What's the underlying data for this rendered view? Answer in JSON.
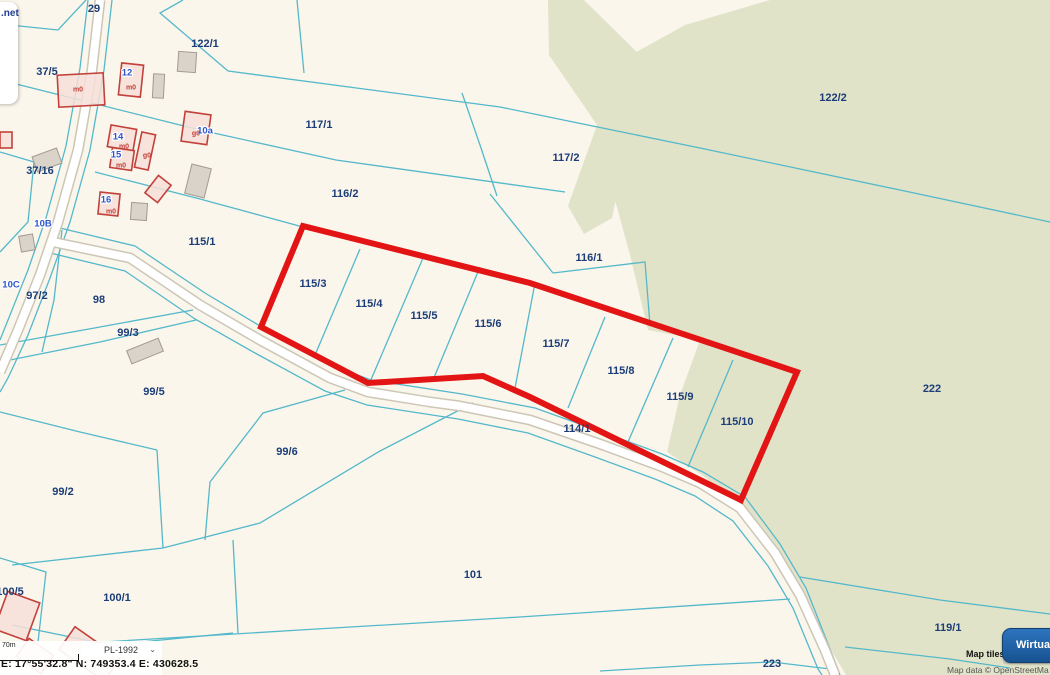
{
  "overlays": {
    "watermark": {
      "net_label": ".net",
      "logo_letter": "M",
      "badge_label": "tr"
    },
    "statusbar": {
      "scale_label": "70m",
      "crs_value": "PL-1992",
      "chevron": "⌄",
      "coords_text": "E: 17°55'32.8\"  N: 749353.4  E: 430628.5"
    },
    "attribution": {
      "line1": "Map tiles",
      "line2": "Map data © OpenStreetMa"
    },
    "button": {
      "label": "Wirtualn"
    }
  },
  "map": {
    "colors": {
      "background": "#faf6ec",
      "forest": "#e1e3c9",
      "parcel_line": "#54b8ca",
      "road_fill": "#ffffff",
      "road_casing": "#cdc6b6",
      "highlight": "#e21414",
      "parcel_label": "#1c3d78",
      "address_label": "#2f55cd",
      "building_red_stroke": "#c2413a",
      "building_red_fill": "#f6dfd8",
      "building_gray_fill": "#d9d3ca",
      "building_gray_stroke": "#a09a90"
    },
    "forest_polys": [
      [
        [
          770,
          0
        ],
        [
          1050,
          0
        ],
        [
          1050,
          675
        ],
        [
          846,
          675
        ],
        [
          800,
          598
        ],
        [
          752,
          518
        ],
        [
          705,
          477
        ],
        [
          667,
          452
        ],
        [
          680,
          395
        ],
        [
          700,
          340
        ],
        [
          648,
          330
        ],
        [
          630,
          255
        ],
        [
          615,
          200
        ],
        [
          603,
          128
        ],
        [
          622,
          60
        ],
        [
          685,
          25
        ]
      ],
      [
        [
          548,
          0
        ],
        [
          584,
          0
        ],
        [
          645,
          60
        ],
        [
          612,
          218
        ],
        [
          584,
          234
        ],
        [
          568,
          206
        ],
        [
          597,
          125
        ],
        [
          549,
          55
        ]
      ]
    ],
    "roads": [
      {
        "pts": [
          [
            100,
            0
          ],
          [
            92,
            70
          ],
          [
            78,
            150
          ],
          [
            58,
            222
          ],
          [
            40,
            275
          ],
          [
            18,
            330
          ],
          [
            0,
            372
          ]
        ]
      },
      {
        "pts": [
          [
            53,
            242
          ],
          [
            130,
            258
          ],
          [
            200,
            305
          ],
          [
            260,
            340
          ],
          [
            330,
            378
          ],
          [
            368,
            392
          ],
          [
            430,
            402
          ],
          [
            460,
            406
          ],
          [
            530,
            420
          ],
          [
            600,
            444
          ],
          [
            660,
            466
          ],
          [
            700,
            483
          ],
          [
            740,
            508
          ],
          [
            775,
            553
          ],
          [
            800,
            595
          ],
          [
            825,
            650
          ],
          [
            835,
            675
          ]
        ]
      }
    ],
    "parcel_lines": [
      [
        [
          0,
          24
        ],
        [
          58,
          30
        ],
        [
          86,
          0
        ]
      ],
      [
        [
          183,
          0
        ],
        [
          160,
          13
        ],
        [
          228,
          71
        ]
      ],
      [
        [
          297,
          0
        ],
        [
          304,
          73
        ]
      ],
      [
        [
          228,
          71
        ],
        [
          500,
          107
        ],
        [
          700,
          148
        ],
        [
          900,
          190
        ],
        [
          1050,
          222
        ]
      ],
      [
        [
          0,
          80
        ],
        [
          60,
          95
        ],
        [
          200,
          130
        ],
        [
          336,
          160
        ],
        [
          565,
          192
        ]
      ],
      [
        [
          95,
          172
        ],
        [
          200,
          199
        ],
        [
          303,
          227
        ]
      ],
      [
        [
          462,
          93
        ],
        [
          480,
          145
        ],
        [
          497,
          196
        ]
      ],
      [
        [
          490,
          194
        ],
        [
          553,
          273
        ]
      ],
      [
        [
          553,
          273
        ],
        [
          645,
          262
        ],
        [
          650,
          325
        ]
      ],
      [
        [
          0,
          152
        ],
        [
          34,
          162
        ],
        [
          28,
          222
        ],
        [
          0,
          252
        ]
      ],
      [
        [
          62,
          230
        ],
        [
          54,
          300
        ],
        [
          42,
          352
        ]
      ],
      [
        [
          0,
          345
        ],
        [
          100,
          327
        ],
        [
          193,
          310
        ]
      ],
      [
        [
          0,
          362
        ],
        [
          100,
          342
        ],
        [
          196,
          320
        ]
      ],
      [
        [
          0,
          412
        ],
        [
          80,
          432
        ],
        [
          157,
          450
        ]
      ],
      [
        [
          157,
          450
        ],
        [
          163,
          548
        ]
      ],
      [
        [
          345,
          390
        ],
        [
          263,
          413
        ],
        [
          210,
          482
        ],
        [
          205,
          540
        ]
      ],
      [
        [
          473,
          403
        ],
        [
          380,
          451
        ],
        [
          260,
          523
        ],
        [
          163,
          548
        ],
        [
          12,
          565
        ]
      ],
      [
        [
          12,
          625
        ],
        [
          110,
          645
        ],
        [
          233,
          633
        ]
      ],
      [
        [
          233,
          540
        ],
        [
          238,
          633
        ]
      ],
      [
        [
          0,
          558
        ],
        [
          46,
          572
        ],
        [
          38,
          642
        ]
      ],
      [
        [
          600,
          671
        ],
        [
          700,
          665
        ],
        [
          772,
          662
        ],
        [
          830,
          669
        ]
      ],
      [
        [
          800,
          577
        ],
        [
          940,
          600
        ],
        [
          1050,
          614
        ]
      ],
      [
        [
          845,
          647
        ],
        [
          950,
          659
        ],
        [
          1010,
          668
        ]
      ],
      [
        [
          70,
          644
        ],
        [
          300,
          630
        ],
        [
          520,
          617
        ],
        [
          790,
          599
        ]
      ],
      [
        [
          60,
          228
        ],
        [
          135,
          246
        ],
        [
          205,
          293
        ],
        [
          265,
          329
        ],
        [
          336,
          367
        ],
        [
          371,
          380
        ],
        [
          462,
          394
        ],
        [
          535,
          408
        ],
        [
          602,
          432
        ],
        [
          662,
          454
        ],
        [
          703,
          472
        ],
        [
          745,
          497
        ],
        [
          780,
          544
        ],
        [
          806,
          588
        ],
        [
          830,
          649
        ],
        [
          840,
          675
        ]
      ],
      [
        [
          46,
          252
        ],
        [
          125,
          271
        ],
        [
          195,
          319
        ],
        [
          255,
          353
        ],
        [
          325,
          391
        ],
        [
          367,
          405
        ],
        [
          458,
          419
        ],
        [
          528,
          433
        ],
        [
          595,
          457
        ],
        [
          655,
          479
        ],
        [
          695,
          496
        ],
        [
          733,
          521
        ],
        [
          768,
          566
        ],
        [
          793,
          608
        ],
        [
          818,
          669
        ],
        [
          822,
          675
        ]
      ],
      [
        [
          112,
          0
        ],
        [
          104,
          70
        ],
        [
          90,
          150
        ],
        [
          70,
          222
        ],
        [
          50,
          278
        ],
        [
          28,
          335
        ],
        [
          8,
          378
        ],
        [
          0,
          392
        ]
      ],
      [
        [
          88,
          0
        ],
        [
          80,
          68
        ],
        [
          66,
          146
        ],
        [
          46,
          218
        ],
        [
          28,
          270
        ],
        [
          6,
          325
        ],
        [
          0,
          340
        ]
      ],
      [
        [
          360,
          249
        ],
        [
          315,
          355
        ]
      ],
      [
        [
          423,
          258
        ],
        [
          370,
          382
        ]
      ],
      [
        [
          480,
          267
        ],
        [
          433,
          380
        ]
      ],
      [
        [
          535,
          283
        ],
        [
          515,
          388
        ]
      ],
      [
        [
          605,
          317
        ],
        [
          568,
          408
        ]
      ],
      [
        [
          673,
          338
        ],
        [
          628,
          442
        ]
      ],
      [
        [
          733,
          360
        ],
        [
          688,
          467
        ]
      ]
    ],
    "highlight_polygon": [
      [
        303,
        226
      ],
      [
        530,
        283
      ],
      [
        797,
        372
      ],
      [
        741,
        500
      ],
      [
        530,
        397
      ],
      [
        483,
        376
      ],
      [
        368,
        383
      ],
      [
        261,
        327
      ]
    ],
    "buildings_red": [
      {
        "x": 58,
        "y": 74,
        "w": 46,
        "h": 32,
        "r": -3
      },
      {
        "x": 120,
        "y": 64,
        "w": 22,
        "h": 32,
        "r": 6
      },
      {
        "x": 109,
        "y": 127,
        "w": 26,
        "h": 22,
        "r": 10
      },
      {
        "x": 111,
        "y": 149,
        "w": 22,
        "h": 20,
        "r": 8
      },
      {
        "x": 138,
        "y": 133,
        "w": 14,
        "h": 36,
        "r": 12
      },
      {
        "x": 183,
        "y": 113,
        "w": 26,
        "h": 30,
        "r": 8
      },
      {
        "x": 99,
        "y": 193,
        "w": 20,
        "h": 22,
        "r": 6
      },
      {
        "x": 150,
        "y": 178,
        "w": 16,
        "h": 22,
        "r": 38
      },
      {
        "x": 0,
        "y": 132,
        "w": 12,
        "h": 16,
        "r": 0
      },
      {
        "x": 62,
        "y": 640,
        "w": 55,
        "h": 28,
        "r": 35
      },
      {
        "x": 20,
        "y": 645,
        "w": 30,
        "h": 22,
        "r": 35
      },
      {
        "x": 0,
        "y": 596,
        "w": 34,
        "h": 40,
        "r": 20
      }
    ],
    "buildings_gray": [
      {
        "x": 178,
        "y": 52,
        "w": 18,
        "h": 20,
        "r": 4
      },
      {
        "x": 153,
        "y": 74,
        "w": 11,
        "h": 24,
        "r": 3
      },
      {
        "x": 188,
        "y": 166,
        "w": 20,
        "h": 30,
        "r": 14
      },
      {
        "x": 131,
        "y": 203,
        "w": 16,
        "h": 17,
        "r": 4
      },
      {
        "x": 34,
        "y": 152,
        "w": 26,
        "h": 16,
        "r": -20
      },
      {
        "x": 128,
        "y": 344,
        "w": 34,
        "h": 14,
        "r": -22
      },
      {
        "x": 20,
        "y": 235,
        "w": 14,
        "h": 16,
        "r": -10
      }
    ],
    "parcel_labels": [
      {
        "t": "29",
        "x": 94,
        "y": 8
      },
      {
        "t": "122/1",
        "x": 205,
        "y": 43
      },
      {
        "t": "122/2",
        "x": 833,
        "y": 97
      },
      {
        "t": "37/5",
        "x": 47,
        "y": 71
      },
      {
        "t": "117/1",
        "x": 319,
        "y": 124
      },
      {
        "t": "117/2",
        "x": 566,
        "y": 157
      },
      {
        "t": "116/2",
        "x": 345,
        "y": 193
      },
      {
        "t": "116/1",
        "x": 589,
        "y": 257
      },
      {
        "t": "115/1",
        "x": 202,
        "y": 241
      },
      {
        "t": "37/16",
        "x": 40,
        "y": 170
      },
      {
        "t": "97/2",
        "x": 37,
        "y": 295
      },
      {
        "t": "98",
        "x": 99,
        "y": 299
      },
      {
        "t": "99/3",
        "x": 128,
        "y": 332
      },
      {
        "t": "99/5",
        "x": 154,
        "y": 391
      },
      {
        "t": "99/6",
        "x": 287,
        "y": 451
      },
      {
        "t": "99/2",
        "x": 63,
        "y": 491
      },
      {
        "t": "100/5",
        "x": 10,
        "y": 591
      },
      {
        "t": "100/1",
        "x": 117,
        "y": 597
      },
      {
        "t": "101",
        "x": 473,
        "y": 574
      },
      {
        "t": "114/1",
        "x": 577,
        "y": 428
      },
      {
        "t": "115/3",
        "x": 313,
        "y": 283
      },
      {
        "t": "115/4",
        "x": 369,
        "y": 303
      },
      {
        "t": "115/5",
        "x": 424,
        "y": 315
      },
      {
        "t": "115/6",
        "x": 488,
        "y": 323
      },
      {
        "t": "115/7",
        "x": 556,
        "y": 343
      },
      {
        "t": "115/8",
        "x": 621,
        "y": 370
      },
      {
        "t": "115/9",
        "x": 680,
        "y": 396
      },
      {
        "t": "115/10",
        "x": 737,
        "y": 421
      },
      {
        "t": "222",
        "x": 932,
        "y": 388
      },
      {
        "t": "223",
        "x": 772,
        "y": 663
      },
      {
        "t": "119/1",
        "x": 948,
        "y": 627
      }
    ],
    "address_labels": [
      {
        "t": "10a",
        "x": 205,
        "y": 130
      },
      {
        "t": "10B",
        "x": 43,
        "y": 223
      },
      {
        "t": "10C",
        "x": 11,
        "y": 284
      },
      {
        "t": "12",
        "x": 127,
        "y": 72
      },
      {
        "t": "14",
        "x": 118,
        "y": 136
      },
      {
        "t": "15",
        "x": 116,
        "y": 154
      },
      {
        "t": "16",
        "x": 106,
        "y": 199
      }
    ],
    "building_labels": [
      {
        "t": "m0",
        "x": 78,
        "y": 89
      },
      {
        "t": "m0",
        "x": 131,
        "y": 87
      },
      {
        "t": "m0",
        "x": 124,
        "y": 146
      },
      {
        "t": "m0",
        "x": 121,
        "y": 165
      },
      {
        "t": "m0",
        "x": 111,
        "y": 211
      },
      {
        "t": "g0",
        "x": 196,
        "y": 133
      },
      {
        "t": "g0",
        "x": 147,
        "y": 155
      }
    ]
  }
}
